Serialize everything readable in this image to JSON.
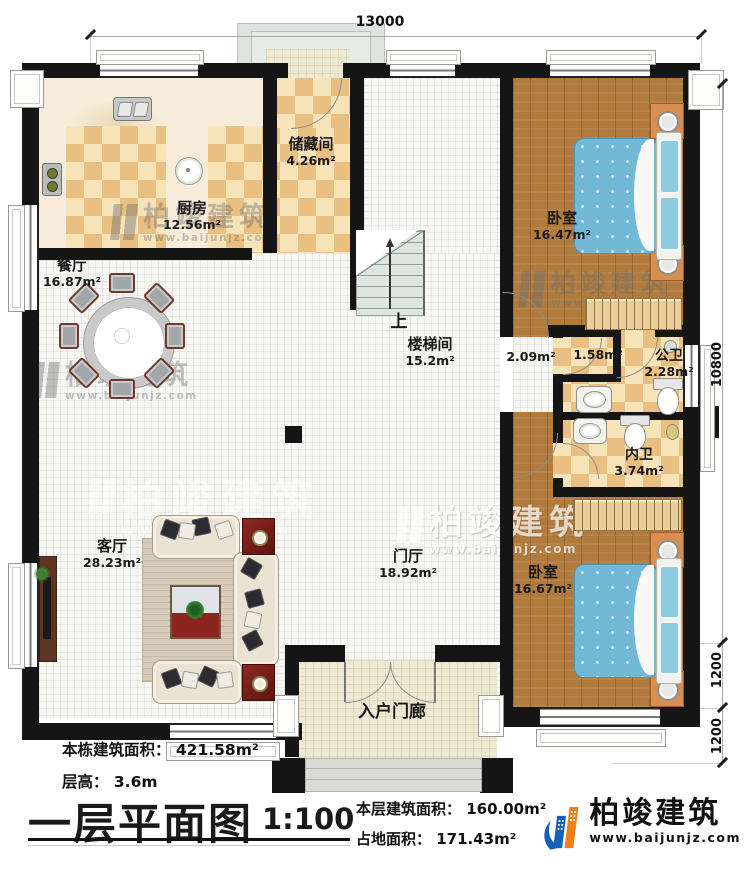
{
  "plan": {
    "dimensions": {
      "top": "13000",
      "right_main": "10800",
      "right_mid": "1200",
      "right_bottom": "1200"
    },
    "rooms": {
      "kitchen": {
        "name": "厨房",
        "area": "12.56m²"
      },
      "storage": {
        "name": "储藏间",
        "area": "4.26m²"
      },
      "dining": {
        "name": "餐厅",
        "area": "16.87m²"
      },
      "bedroom_top": {
        "name": "卧室",
        "area": "16.47m²"
      },
      "stairwell": {
        "name": "楼梯间",
        "area": "15.2m²",
        "up": "上"
      },
      "hallway": {
        "area": "2.09m²"
      },
      "closet_small": {
        "area": "1.58m²"
      },
      "public_bath": {
        "name": "公卫",
        "area": "2.28m²"
      },
      "private_bath": {
        "name": "内卫",
        "area": "3.74m²"
      },
      "living": {
        "name": "客厅",
        "area": "28.23m²"
      },
      "foyer": {
        "name": "门厅",
        "area": "18.92m²"
      },
      "bedroom_bottom": {
        "name": "卧室",
        "area": "16.67m²"
      },
      "entry_porch": {
        "name": "入户门廊"
      }
    }
  },
  "title_block": {
    "stat_total_area": "本栋建筑面积： 421.58m²",
    "stat_floor_height": "层高： 3.6m",
    "title": "一层平面图",
    "scale": "1:100",
    "stat_floor_area": "本层建筑面积： 160.00m²",
    "stat_footprint": "占地面积： 171.43m²"
  },
  "brand": {
    "name": "柏竣建筑",
    "website": "www.baijunjz.com"
  },
  "watermark": {
    "name": "柏竣建筑",
    "website": "www.baijunjz.com"
  },
  "colors": {
    "wall": "#151515",
    "tile_dark": "#e9c081",
    "tile_light": "#f6e3b8",
    "wood": "#b07b3c",
    "bed": "#71b9d6",
    "brand_blue": "#1660b8",
    "brand_orange": "#ef7f1a"
  }
}
